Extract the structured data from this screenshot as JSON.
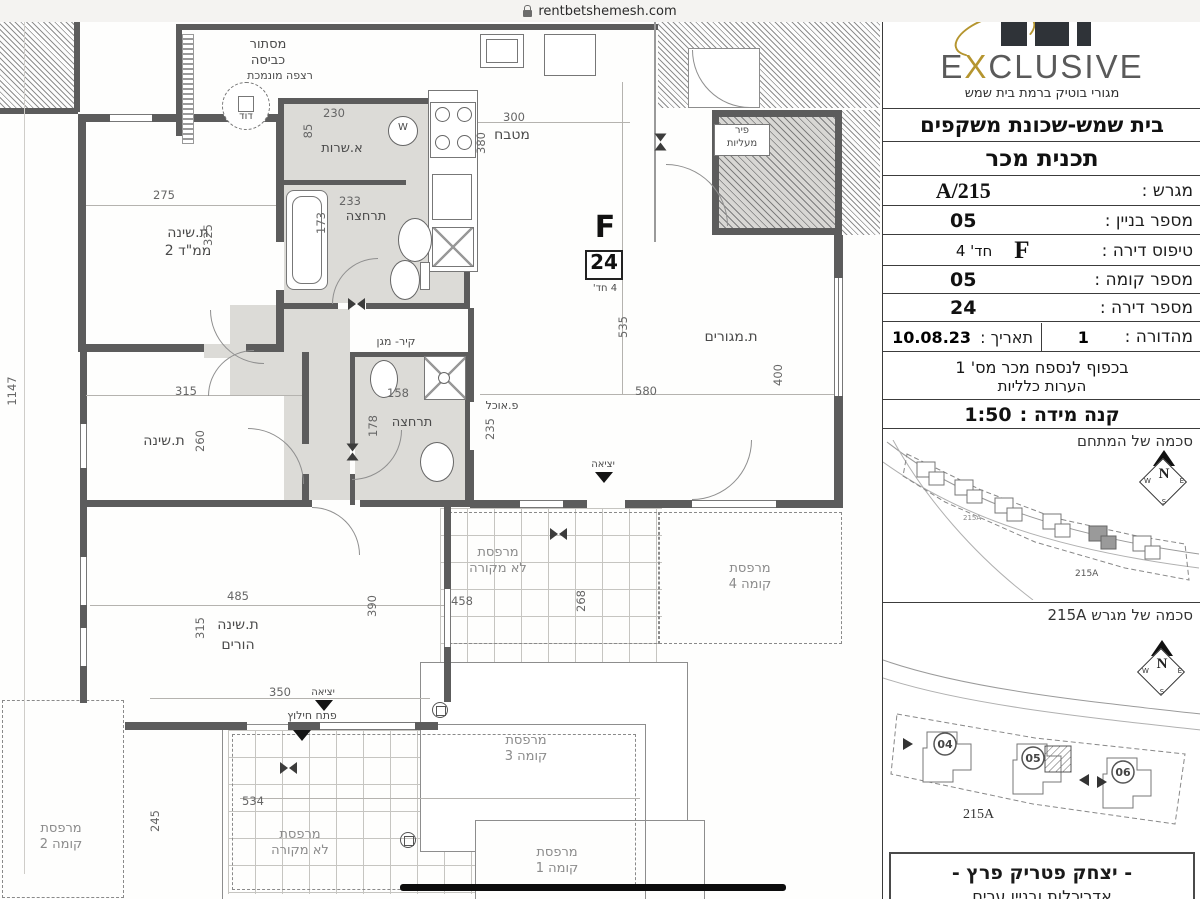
{
  "browser": {
    "url": "rentbetshemesh.com"
  },
  "colors": {
    "wall": "#5c5c5c",
    "floor_gray": "#dcdbd7",
    "gold": "#b5952f"
  },
  "panel": {
    "logo": {
      "e": "E",
      "x": "X",
      "rest": "CLUSIVE",
      "tagline": "מגורי בוטיק ברמת בית שמש"
    },
    "title_line1": "בית שמש-שכונת משקפים",
    "title_line2": "תכנית מכר",
    "fields": {
      "plot": {
        "label": "מגרש :",
        "value": "215/A"
      },
      "building": {
        "label": "מספר בניין :",
        "value": "05"
      },
      "apt_type": {
        "label": "טיפוס דירה :",
        "value": "F",
        "rooms": "חד' 4"
      },
      "floor": {
        "label": "מספר קומה :",
        "value": "05"
      },
      "apt_num": {
        "label": "מספר דירה :",
        "value": "24"
      },
      "edition": {
        "label": "מהדורה :",
        "value": "1"
      },
      "date": {
        "label": "תאריך :",
        "value": "10.08.23"
      },
      "scale": {
        "label": "קנה מידה :",
        "value": "1:50"
      }
    },
    "notes": {
      "line1": "בכפוף לנספח מכר מס' 1",
      "line2": "הערות כלליות"
    },
    "site1": {
      "label": "סכמה של המתחם",
      "plot_tag": "215A"
    },
    "site2": {
      "label": "סכמה של מגרש 215A",
      "plot_tag": "215A",
      "buildings": [
        "04",
        "05",
        "06"
      ]
    },
    "compass": {
      "n": "N",
      "e": "E",
      "s": "S",
      "w": "W"
    },
    "architect": {
      "line1": "- יצחק פטריק פרץ -",
      "line2": "אדריכלות ובניין ערים"
    }
  },
  "plan": {
    "unit": {
      "letter": "F",
      "number": "24",
      "rooms": "4 חד'"
    },
    "rooms": {
      "laundry1": "מסתור",
      "laundry2": "כביסה",
      "lowered_floor": "רצפה מונמכת",
      "boiler": "דוד",
      "service": "א.שרות",
      "bath": "תרחצה",
      "kitchen": "מטבח",
      "living": "ת.מגורים",
      "shelter_wall": "קיר- מגן",
      "bath2": "תרחצה",
      "dining": "פ.אוכל",
      "bedroom": "ת.שינה",
      "mamad1": "ת.שינה",
      "mamad2": "ממ\"ד 2",
      "parents1": "ת.שינה",
      "parents2": "הורים",
      "elevator1": "פיר",
      "elevator2": "מעליות",
      "exit": "יציאה",
      "rescue": "פתח חילוץ",
      "washer": "W",
      "balc_unc1": "מרפסת",
      "balc_unc2": "לא מקורה",
      "balc4_1": "מרפסת",
      "balc4_2": "קומה 4",
      "balc3_1": "מרפסת",
      "balc3_2": "קומה 3",
      "balc2_1": "מרפסת",
      "balc2_2": "קומה 2",
      "balc1_1": "מרפסת",
      "balc1_2": "קומה 1"
    },
    "dims": {
      "side": "1147",
      "mamad_w": "275",
      "mamad_h": "325",
      "service_w": "230",
      "service_h": "85",
      "bath_w": "233",
      "bath_h": "173",
      "kitchen_w": "300",
      "kitchen_h": "380",
      "living_h1": "535",
      "living_h2": "400",
      "living_w": "580",
      "bath2_w": "158",
      "bath2_h": "178",
      "hall_h": "235",
      "bedroom_w": "315",
      "bedroom_h": "260",
      "parents_w": "485",
      "parents_h": "315",
      "parents_r": "390",
      "parents_b": "350",
      "balc_mid_w": "458",
      "balc_mid_h": "268",
      "balc_bot_w": "534",
      "balc_bot_h": "245"
    }
  }
}
